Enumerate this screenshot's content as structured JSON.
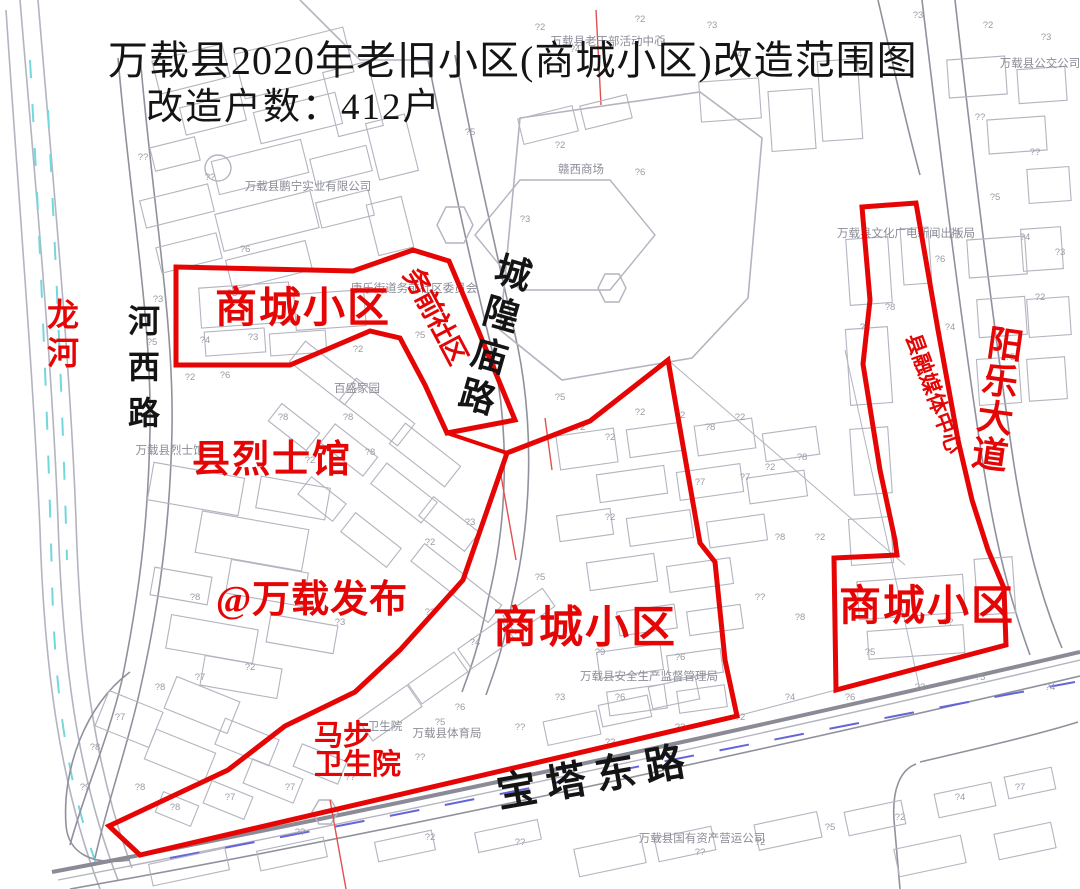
{
  "title": {
    "line1": "万载县2020年老旧小区(商城小区)改造范围图",
    "line2": "改造户数：412户"
  },
  "colors": {
    "boundary": "#e60505",
    "red_text": "#e60505",
    "black_text": "#141414",
    "gray_label": "#8b8c96",
    "marker": "#9a9ba6",
    "blue_dash": "#6565da",
    "cyan_dash": "#74d6de",
    "map_line": "#b3b4bf",
    "road_line": "#90919c"
  },
  "boundaries": [
    {
      "name": "boundary-northwest-block",
      "points": "176,267 353,271 413,250 449,261 478,330 515,420 447,433 425,385 400,338 370,331 290,365 176,365",
      "closed": true,
      "width": 5
    },
    {
      "name": "boundary-connector",
      "points": "447,433 507,453",
      "closed": false,
      "width": 4
    },
    {
      "name": "boundary-central-block",
      "points": "507,453 590,421 668,360 700,543 715,562 725,660 737,716 140,855 109,826 228,770 285,726 355,692 400,650 463,580",
      "closed": true,
      "width": 5
    },
    {
      "name": "boundary-east-block",
      "points": "862,207 916,203 938,330 958,440 972,500 988,550 1004,588 1006,645 836,690 834,558 897,555 895,540 880,470 863,364 870,300",
      "closed": true,
      "width": 5
    }
  ],
  "area_labels": [
    {
      "name": "label-shangcheng-nw",
      "text": "商城小区",
      "x": 303,
      "y": 322,
      "size": 42,
      "ls": 2
    },
    {
      "name": "label-shangcheng-center",
      "text": "商城小区",
      "x": 585,
      "y": 642,
      "size": 44,
      "ls": 2
    },
    {
      "name": "label-shangcheng-east",
      "text": "商城小区",
      "x": 927,
      "y": 620,
      "size": 42,
      "ls": 2
    },
    {
      "name": "label-lieshiguan",
      "text": "县烈士馆",
      "x": 272,
      "y": 472,
      "size": 38,
      "ls": 2
    },
    {
      "name": "label-watermark-wanzaifabu",
      "text": "@万载发布",
      "x": 312,
      "y": 612,
      "size": 38,
      "ls": 1
    },
    {
      "name": "label-mabu-line1",
      "text": "马步",
      "x": 314,
      "y": 745,
      "size": 29,
      "anchor": "start"
    },
    {
      "name": "label-mabu-line2",
      "text": "卫生院",
      "x": 314,
      "y": 774,
      "size": 29,
      "anchor": "start"
    },
    {
      "name": "label-wuqian-shequ",
      "text": "务前社区",
      "x": 427,
      "y": 320,
      "size": 27,
      "rotate": 62,
      "ls": -1
    },
    {
      "name": "label-rongmei-center",
      "text": "县融媒体中心",
      "x": 927,
      "y": 396,
      "size": 21,
      "rotate": 70
    },
    {
      "name": "label-longhe-river",
      "text": "龙河",
      "x": 63,
      "y": 345,
      "size": 32,
      "vertical": true,
      "spacing": 38
    },
    {
      "name": "label-yangle-avenue",
      "text": "阳乐大道",
      "x": 996,
      "y": 412,
      "size": 36,
      "vertical": true,
      "spacing": 37,
      "rotate": 8
    }
  ],
  "road_labels": [
    {
      "name": "label-hexi-road",
      "text": "河西路",
      "x": 144,
      "y": 378,
      "size": 32,
      "vertical": true,
      "spacing": 46
    },
    {
      "name": "label-chenghuangmiao-road",
      "text": "城隍庙路",
      "x": 492,
      "y": 347,
      "size": 36,
      "vertical": true,
      "spacing": 43,
      "rotate": 16
    },
    {
      "name": "label-baota-east-road",
      "text": "宝塔东路",
      "x": 598,
      "y": 790,
      "size": 40,
      "rotate": -10,
      "ls": 10
    }
  ],
  "small_labels": [
    {
      "name": "label-pengning-company",
      "text": "万载县鹏宁实业有限公司",
      "x": 308,
      "y": 190
    },
    {
      "name": "label-ganxi-mall",
      "text": "赣西商场",
      "x": 581,
      "y": 173
    },
    {
      "name": "label-laoganbu-center",
      "text": "万载县老干部活动中心",
      "x": 608,
      "y": 45
    },
    {
      "name": "label-wenhua-press-bureau",
      "text": "万载县文化广电新闻出版局",
      "x": 906,
      "y": 237
    },
    {
      "name": "label-bus-company",
      "text": "万载县公交公司",
      "x": 1040,
      "y": 67
    },
    {
      "name": "label-kangle-committee",
      "text": "康乐街道务前社区委员会",
      "x": 414,
      "y": 292
    },
    {
      "name": "label-baisheng-garden",
      "text": "百盛家园",
      "x": 357,
      "y": 392
    },
    {
      "name": "label-lieshiguan-gray",
      "text": "万载县烈士馆",
      "x": 170,
      "y": 454
    },
    {
      "name": "label-weishengyuan-gray",
      "text": "卫生院",
      "x": 385,
      "y": 730
    },
    {
      "name": "label-sports-bureau",
      "text": "万载县体育局",
      "x": 447,
      "y": 737
    },
    {
      "name": "label-safety-bureau",
      "text": "万载县安全生产监督管理局",
      "x": 649,
      "y": 680
    },
    {
      "name": "label-state-assets-company",
      "text": "万载县国有资产营运公司",
      "x": 702,
      "y": 842
    }
  ],
  "markers": [
    {
      "x": 712,
      "y": 28,
      "t": "?3"
    },
    {
      "x": 737,
      "y": 57,
      "t": "?4"
    },
    {
      "x": 918,
      "y": 18,
      "t": "?3"
    },
    {
      "x": 988,
      "y": 28,
      "t": "?2"
    },
    {
      "x": 1046,
      "y": 40,
      "t": "?3"
    },
    {
      "x": 640,
      "y": 22,
      "t": "?2"
    },
    {
      "x": 540,
      "y": 30,
      "t": "?2"
    },
    {
      "x": 575,
      "y": 52,
      "t": "?4"
    },
    {
      "x": 660,
      "y": 42,
      "t": "?5"
    },
    {
      "x": 143,
      "y": 160,
      "t": "??"
    },
    {
      "x": 210,
      "y": 180,
      "t": "??"
    },
    {
      "x": 470,
      "y": 135,
      "t": "?5"
    },
    {
      "x": 560,
      "y": 148,
      "t": "?2"
    },
    {
      "x": 640,
      "y": 175,
      "t": "?6"
    },
    {
      "x": 525,
      "y": 222,
      "t": "?3"
    },
    {
      "x": 245,
      "y": 252,
      "t": "?6"
    },
    {
      "x": 158,
      "y": 302,
      "t": "?3"
    },
    {
      "x": 232,
      "y": 296,
      "t": "?3"
    },
    {
      "x": 152,
      "y": 345,
      "t": "?5"
    },
    {
      "x": 205,
      "y": 343,
      "t": "?4"
    },
    {
      "x": 253,
      "y": 340,
      "t": "?3"
    },
    {
      "x": 190,
      "y": 380,
      "t": "?2"
    },
    {
      "x": 225,
      "y": 378,
      "t": "?6"
    },
    {
      "x": 420,
      "y": 338,
      "t": "?5"
    },
    {
      "x": 358,
      "y": 352,
      "t": "?2"
    },
    {
      "x": 283,
      "y": 420,
      "t": "?8"
    },
    {
      "x": 348,
      "y": 420,
      "t": "?8"
    },
    {
      "x": 310,
      "y": 463,
      "t": "?2"
    },
    {
      "x": 370,
      "y": 455,
      "t": "?8"
    },
    {
      "x": 470,
      "y": 525,
      "t": "?3"
    },
    {
      "x": 430,
      "y": 545,
      "t": "?2"
    },
    {
      "x": 560,
      "y": 400,
      "t": "?5"
    },
    {
      "x": 580,
      "y": 430,
      "t": "?2"
    },
    {
      "x": 610,
      "y": 440,
      "t": "?2"
    },
    {
      "x": 640,
      "y": 415,
      "t": "?2"
    },
    {
      "x": 680,
      "y": 418,
      "t": "?2"
    },
    {
      "x": 710,
      "y": 430,
      "t": "?8"
    },
    {
      "x": 740,
      "y": 420,
      "t": "?2"
    },
    {
      "x": 700,
      "y": 485,
      "t": "?7"
    },
    {
      "x": 745,
      "y": 480,
      "t": "?7"
    },
    {
      "x": 770,
      "y": 470,
      "t": "?2"
    },
    {
      "x": 802,
      "y": 460,
      "t": "?8"
    },
    {
      "x": 820,
      "y": 540,
      "t": "?2"
    },
    {
      "x": 780,
      "y": 540,
      "t": "?8"
    },
    {
      "x": 890,
      "y": 310,
      "t": "?8"
    },
    {
      "x": 865,
      "y": 330,
      "t": "?2"
    },
    {
      "x": 950,
      "y": 330,
      "t": "?4"
    },
    {
      "x": 1010,
      "y": 360,
      "t": "?5"
    },
    {
      "x": 1040,
      "y": 300,
      "t": "?2"
    },
    {
      "x": 1060,
      "y": 255,
      "t": "?3"
    },
    {
      "x": 980,
      "y": 120,
      "t": "??"
    },
    {
      "x": 1035,
      "y": 155,
      "t": "??"
    },
    {
      "x": 995,
      "y": 200,
      "t": "?5"
    },
    {
      "x": 955,
      "y": 235,
      "t": "?4"
    },
    {
      "x": 1025,
      "y": 240,
      "t": "?4"
    },
    {
      "x": 940,
      "y": 262,
      "t": "?6"
    },
    {
      "x": 195,
      "y": 600,
      "t": "?8"
    },
    {
      "x": 340,
      "y": 625,
      "t": "?3"
    },
    {
      "x": 430,
      "y": 615,
      "t": "??"
    },
    {
      "x": 540,
      "y": 580,
      "t": "?5"
    },
    {
      "x": 475,
      "y": 645,
      "t": "?4"
    },
    {
      "x": 610,
      "y": 520,
      "t": "?2"
    },
    {
      "x": 200,
      "y": 680,
      "t": "?7"
    },
    {
      "x": 250,
      "y": 670,
      "t": "?2"
    },
    {
      "x": 160,
      "y": 690,
      "t": "?8"
    },
    {
      "x": 120,
      "y": 720,
      "t": "?7"
    },
    {
      "x": 95,
      "y": 750,
      "t": "?8"
    },
    {
      "x": 140,
      "y": 790,
      "t": "?8"
    },
    {
      "x": 175,
      "y": 810,
      "t": "?8"
    },
    {
      "x": 230,
      "y": 800,
      "t": "?7"
    },
    {
      "x": 290,
      "y": 790,
      "t": "?7"
    },
    {
      "x": 350,
      "y": 780,
      "t": "??"
    },
    {
      "x": 420,
      "y": 760,
      "t": "??"
    },
    {
      "x": 520,
      "y": 730,
      "t": "??"
    },
    {
      "x": 560,
      "y": 700,
      "t": "?3"
    },
    {
      "x": 620,
      "y": 700,
      "t": "?6"
    },
    {
      "x": 680,
      "y": 660,
      "t": "?6"
    },
    {
      "x": 600,
      "y": 655,
      "t": "?9"
    },
    {
      "x": 760,
      "y": 600,
      "t": "??"
    },
    {
      "x": 800,
      "y": 620,
      "t": "?8"
    },
    {
      "x": 870,
      "y": 655,
      "t": "?5"
    },
    {
      "x": 948,
      "y": 625,
      "t": "??"
    },
    {
      "x": 460,
      "y": 710,
      "t": "?6"
    },
    {
      "x": 440,
      "y": 725,
      "t": "?5"
    },
    {
      "x": 610,
      "y": 745,
      "t": "??"
    },
    {
      "x": 680,
      "y": 730,
      "t": "?2"
    },
    {
      "x": 740,
      "y": 720,
      "t": "?2"
    },
    {
      "x": 790,
      "y": 700,
      "t": "?4"
    },
    {
      "x": 850,
      "y": 700,
      "t": "?6"
    },
    {
      "x": 920,
      "y": 690,
      "t": "?2"
    },
    {
      "x": 980,
      "y": 680,
      "t": "?5"
    },
    {
      "x": 1050,
      "y": 690,
      "t": "?4"
    },
    {
      "x": 300,
      "y": 835,
      "t": "??"
    },
    {
      "x": 430,
      "y": 840,
      "t": "?2"
    },
    {
      "x": 520,
      "y": 845,
      "t": "??"
    },
    {
      "x": 700,
      "y": 855,
      "t": "??"
    },
    {
      "x": 760,
      "y": 845,
      "t": "?2"
    },
    {
      "x": 830,
      "y": 830,
      "t": "?5"
    },
    {
      "x": 900,
      "y": 820,
      "t": "?2"
    },
    {
      "x": 960,
      "y": 800,
      "t": "?4"
    },
    {
      "x": 1020,
      "y": 790,
      "t": "?7"
    },
    {
      "x": 85,
      "y": 790,
      "t": "?9"
    }
  ]
}
